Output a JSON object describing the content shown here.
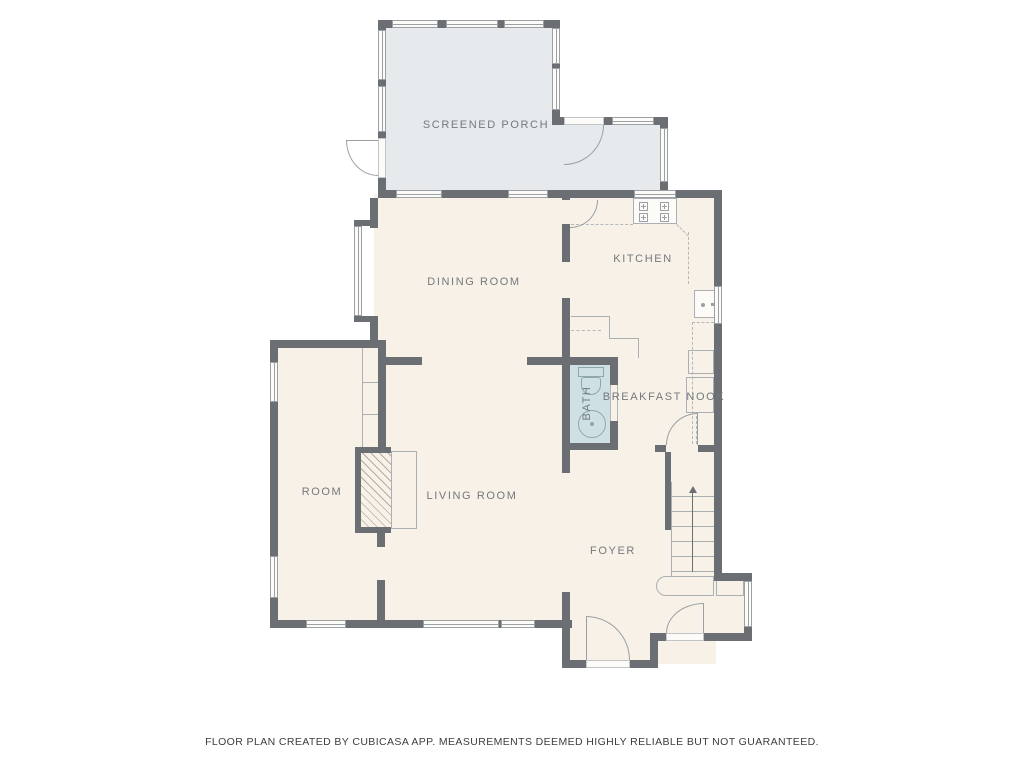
{
  "title": "Floor plan",
  "rooms": [
    {
      "id": "screened-porch",
      "label": "SCREENED PORCH"
    },
    {
      "id": "dining-room",
      "label": "DINING ROOM"
    },
    {
      "id": "kitchen",
      "label": "KITCHEN"
    },
    {
      "id": "bath",
      "label": "BATH"
    },
    {
      "id": "breakfast-nook",
      "label": "BREAKFAST NOOK"
    },
    {
      "id": "room",
      "label": "ROOM"
    },
    {
      "id": "living-room",
      "label": "LIVING ROOM"
    },
    {
      "id": "foyer",
      "label": "FOYER"
    }
  ],
  "footer": {
    "text": "FLOOR PLAN CREATED BY CUBICASA APP. MEASUREMENTS DEEMED HIGHLY RELIABLE BUT NOT GUARANTEED."
  },
  "colors": {
    "background": "#ffffff",
    "wall": "#6b6f73",
    "floor": "#f7f1e8",
    "porch_floor": "#e7eaec",
    "bath_floor": "#cfe0e4",
    "fixture_line": "#9aa0a4",
    "label_text": "#74797d",
    "footer_text": "#3d3d3d"
  },
  "icons": [
    "stove-icon",
    "kitchen-sink-icon",
    "toilet-icon",
    "bath-sink-icon",
    "fireplace-icon",
    "stairs-icon",
    "stairs-up-arrow-icon"
  ]
}
